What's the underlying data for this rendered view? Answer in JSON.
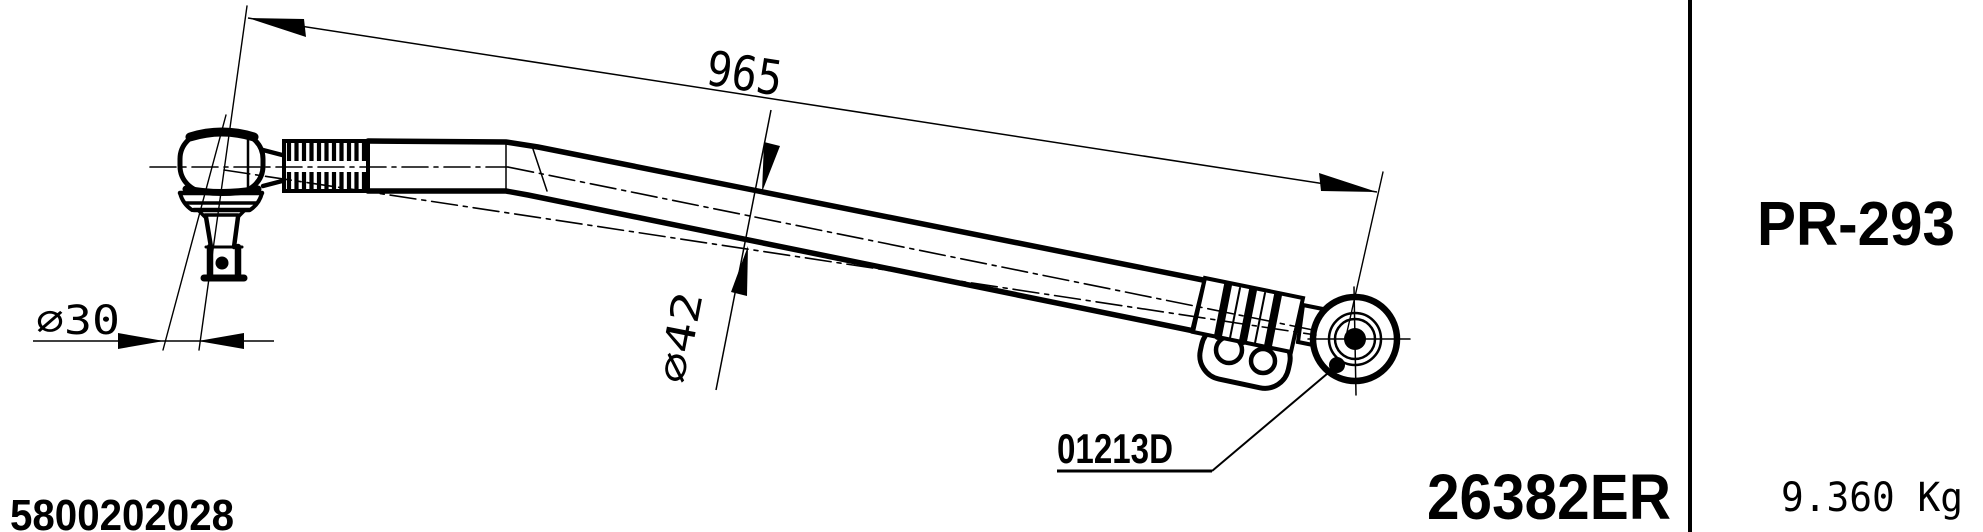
{
  "drawing": {
    "dimensions": {
      "overall_length": "965",
      "ball_stud_diameter": "∅30",
      "rod_diameter": "∅42"
    },
    "detail_code": "01213D",
    "oem_reference": "5800202028",
    "part_number": "26382ER"
  },
  "side_panel": {
    "model_code": "PR-293",
    "weight": "9.360 Kg"
  },
  "colors": {
    "ink": "#000000",
    "paper": "#ffffff"
  }
}
